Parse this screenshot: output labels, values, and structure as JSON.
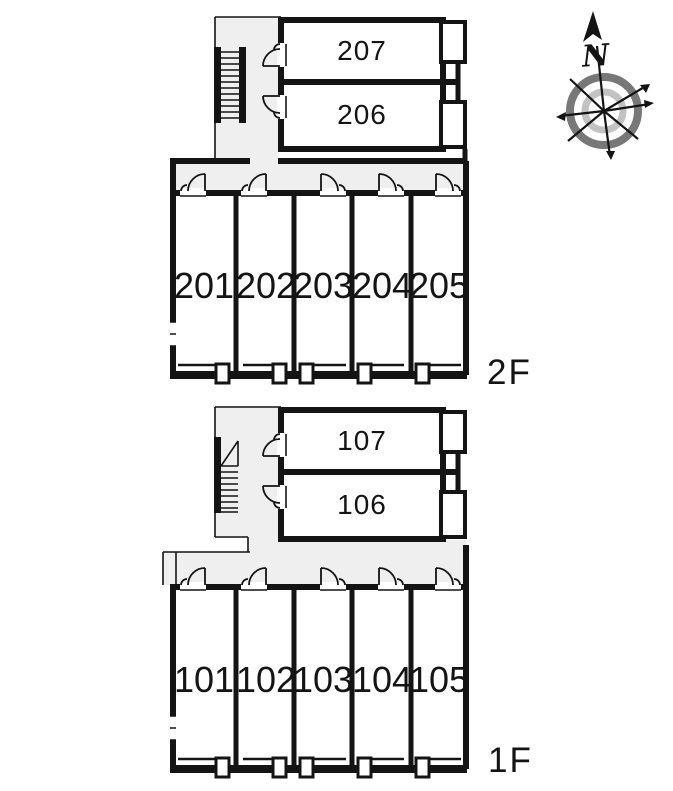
{
  "title": "apartment-floor-plan",
  "colors": {
    "background": "#ffffff",
    "wall": "#141414",
    "text": "#141414",
    "corridor_fill": "#efefef",
    "compass_ring_outer": "#787878",
    "compass_ring_inner": "#c2c2c2"
  },
  "compass": {
    "north_label": "N"
  },
  "floors": [
    {
      "label": "2F",
      "upper_rooms": [
        {
          "number": "207"
        },
        {
          "number": "206"
        }
      ],
      "row_rooms": [
        {
          "number": "201"
        },
        {
          "number": "202"
        },
        {
          "number": "203"
        },
        {
          "number": "204"
        },
        {
          "number": "205"
        }
      ]
    },
    {
      "label": "1F",
      "upper_rooms": [
        {
          "number": "107"
        },
        {
          "number": "106"
        }
      ],
      "row_rooms": [
        {
          "number": "101"
        },
        {
          "number": "102"
        },
        {
          "number": "103"
        },
        {
          "number": "104"
        },
        {
          "number": "105"
        }
      ]
    }
  ]
}
